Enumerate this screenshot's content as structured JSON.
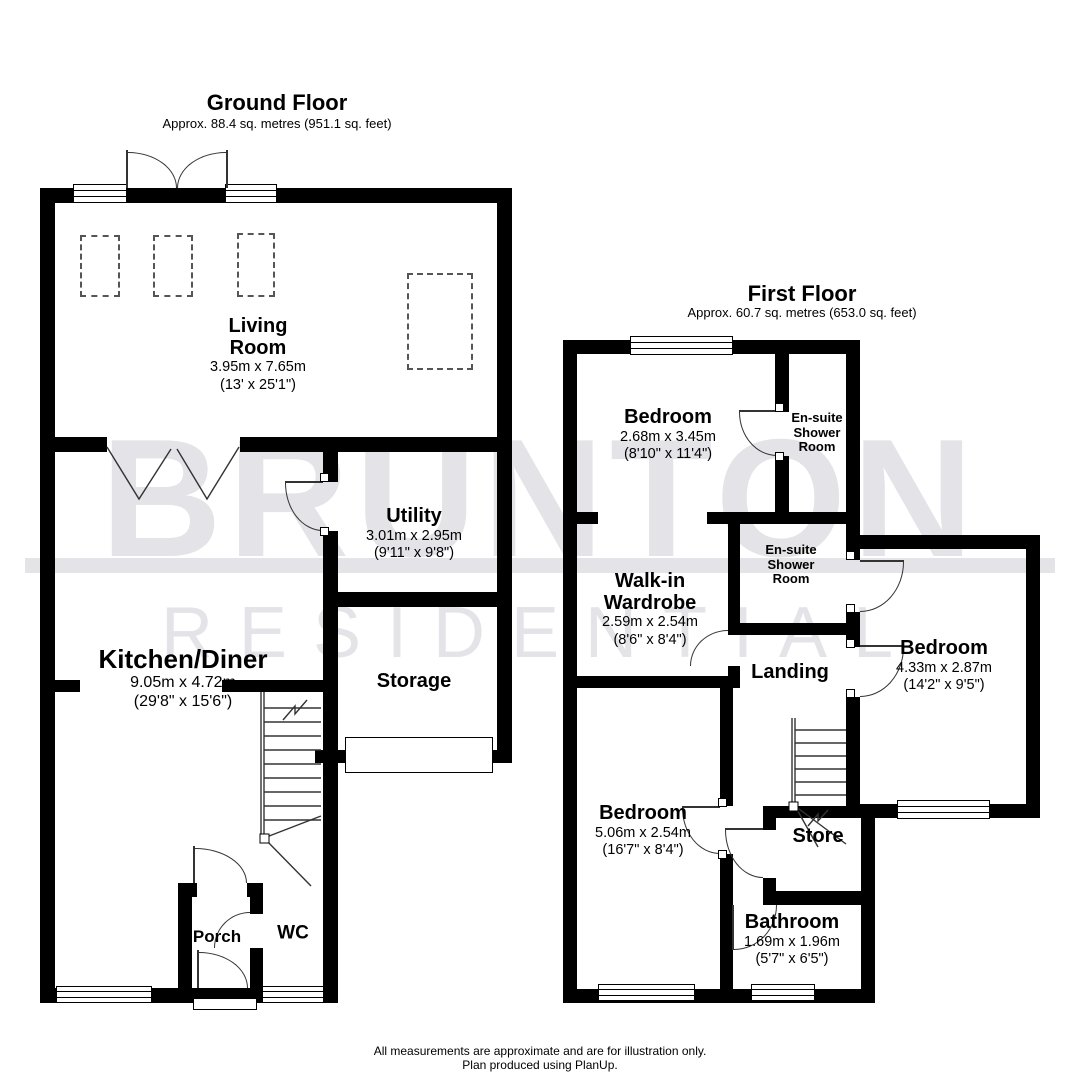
{
  "watermark": {
    "line1": "BRUNTON",
    "line2": "RESIDENTIAL",
    "color": "#e3e3e8"
  },
  "ground_floor": {
    "title": "Ground Floor",
    "subtitle": "Approx. 88.4 sq. metres (951.1 sq. feet)",
    "rooms": {
      "living_room": {
        "name": "Living Room",
        "dims_m": "3.95m x 7.65m",
        "dims_ft": "(13' x 25'1\")"
      },
      "utility": {
        "name": "Utility",
        "dims_m": "3.01m x 2.95m",
        "dims_ft": "(9'11\" x 9'8\")"
      },
      "kitchen_diner": {
        "name": "Kitchen/Diner",
        "dims_m": "9.05m x 4.72m",
        "dims_ft": "(29'8\" x 15'6\")"
      },
      "storage": {
        "name": "Storage"
      },
      "porch": {
        "name": "Porch"
      },
      "wc": {
        "name": "WC"
      }
    }
  },
  "first_floor": {
    "title": "First Floor",
    "subtitle": "Approx. 60.7 sq. metres (653.0 sq. feet)",
    "rooms": {
      "bedroom1": {
        "name": "Bedroom",
        "dims_m": "2.68m x 3.45m",
        "dims_ft": "(8'10\" x 11'4\")"
      },
      "ensuite1": {
        "name": "En-suite Shower Room"
      },
      "walk_in_wardrobe": {
        "name": "Walk-in Wardrobe",
        "dims_m": "2.59m x 2.54m",
        "dims_ft": "(8'6\" x 8'4\")"
      },
      "ensuite2": {
        "name": "En-suite Shower Room"
      },
      "bedroom2": {
        "name": "Bedroom",
        "dims_m": "4.33m x 2.87m",
        "dims_ft": "(14'2\" x 9'5\")"
      },
      "landing": {
        "name": "Landing"
      },
      "bedroom3": {
        "name": "Bedroom",
        "dims_m": "5.06m x 2.54m",
        "dims_ft": "(16'7\" x 8'4\")"
      },
      "store": {
        "name": "Store"
      },
      "bathroom": {
        "name": "Bathroom",
        "dims_m": "1.69m x 1.96m",
        "dims_ft": "(5'7\" x 6'5\")"
      }
    }
  },
  "footer": {
    "line1": "All measurements are approximate and are for illustration only.",
    "line2": "Plan produced using PlanUp."
  }
}
